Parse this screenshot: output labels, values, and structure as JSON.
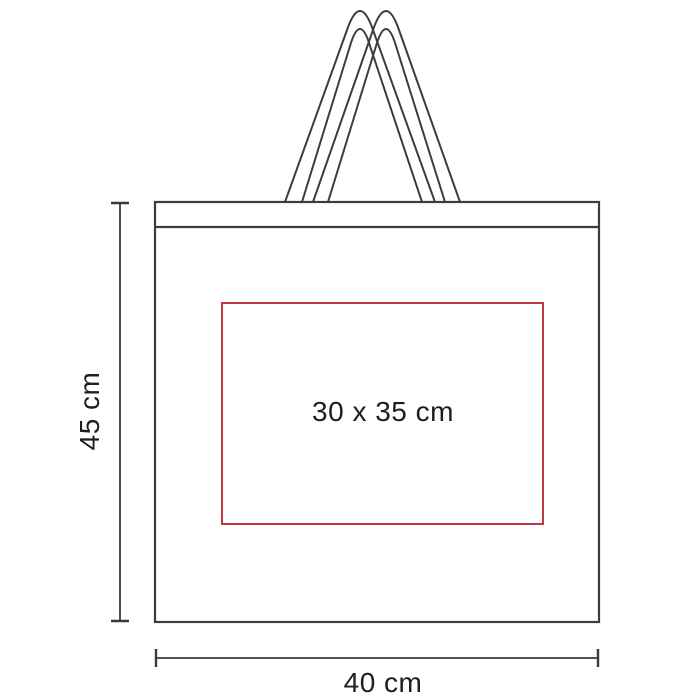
{
  "diagram": {
    "title": "tote-bag-dimension-diagram",
    "labels": {
      "height": "45 cm",
      "width": "40 cm",
      "print_area": "30 x 35 cm"
    },
    "colors": {
      "outline": "#3d3d3d",
      "handle": "#3d3d3d",
      "dimension_line": "#3a3a3a",
      "print_area_border": "#c03a45",
      "text": "#1e1e1e",
      "background": "#ffffff"
    },
    "measurements": {
      "bag_height_cm": 45,
      "bag_width_cm": 40,
      "print_area_cm": "30 x 35"
    }
  }
}
